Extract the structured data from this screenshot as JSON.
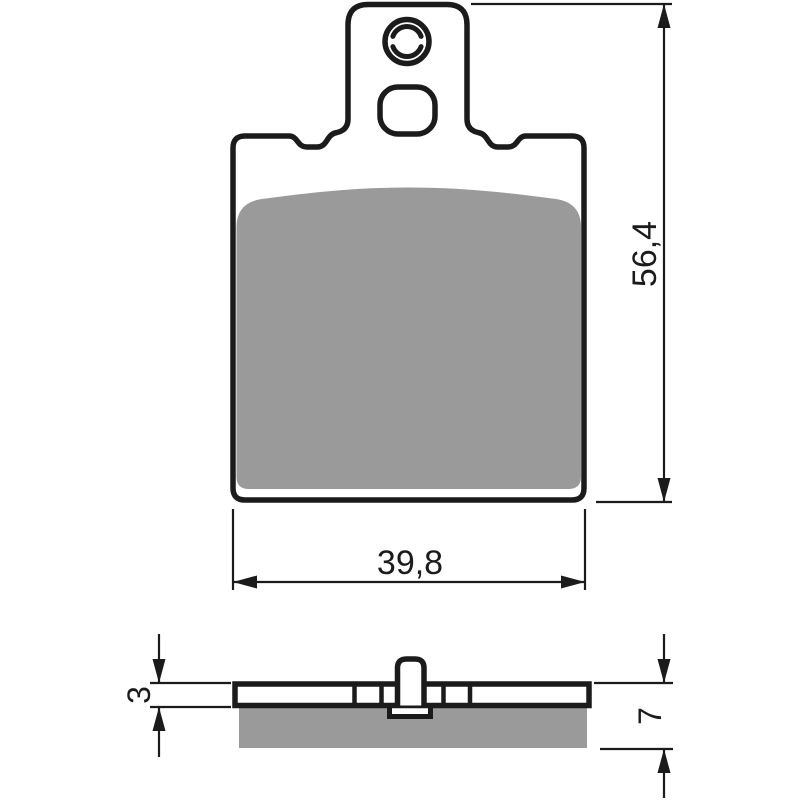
{
  "drawing_type": "brake-pad-dimension-drawing",
  "colors": {
    "background": "#ffffff",
    "line": "#1b1b1b",
    "pad": "#9a9a9a"
  },
  "dimensions": {
    "height_mm": "56,4",
    "width_mm": "39,8",
    "plate_thickness_mm": "3",
    "total_thickness_mm": "7"
  }
}
